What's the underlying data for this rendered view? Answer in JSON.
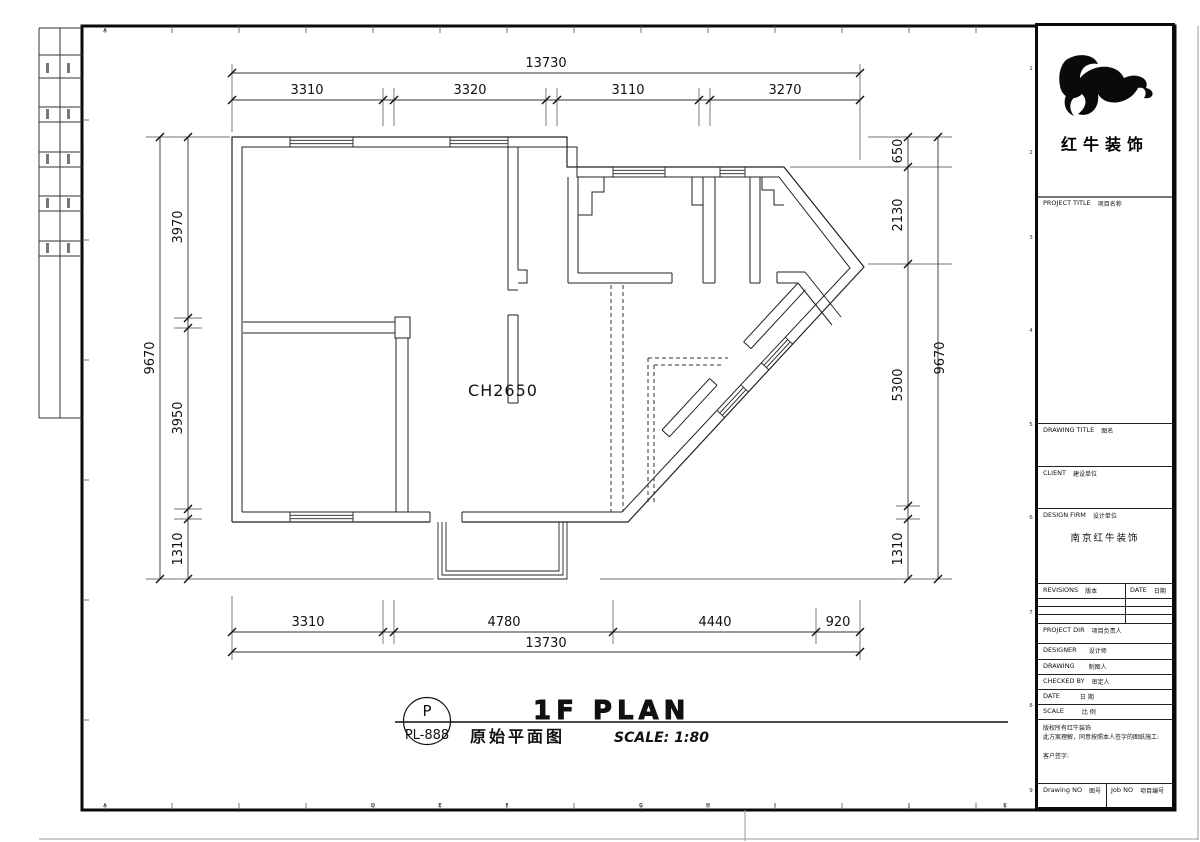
{
  "brand": {
    "name_cn": "红牛装饰",
    "design_firm_value": "南京红牛装饰"
  },
  "title_block": {
    "project_label": "PROJECT TITLE",
    "project_label_cn": "项目名称",
    "drawing_title_label": "DRAWING TITLE",
    "drawing_title_label_cn": "图名",
    "client_label": "CLIENT",
    "client_label_cn": "建设单位",
    "design_firm_label": "DESIGN FIRM",
    "design_firm_label_cn": "设计单位",
    "revisions_label": "REVISIONS",
    "revisions_label_cn": "版本",
    "date_col_label": "DATE",
    "date_col_label_cn": "日期",
    "project_dir_label": "PROJECT DIR",
    "project_dir_label_cn": "项目负责人",
    "designer_label": "DESIGNER",
    "designer_label_cn": "设计师",
    "drawing_by_label": "DRAWING",
    "drawing_by_label_cn": "制图人",
    "checked_by_label": "CHECKED BY",
    "checked_by_label_cn": "审定人",
    "date_label": "DATE",
    "date_label_cn": "日 期",
    "scale_label": "SCALE",
    "scale_label_cn": "比 例",
    "copyright_line1": "版权所有红牛装饰",
    "copyright_line2": "此方案理解，同意按照本人签字的图纸施工:",
    "customer_sign_label": "客户签字:",
    "drawing_no_label": "Drawing NO",
    "drawing_no_label_cn": "图号",
    "job_no_label": "Job NO",
    "job_no_label_cn": "项目编号"
  },
  "plan": {
    "ceiling_label": "CH2650"
  },
  "dims": {
    "top": {
      "overall": "13730",
      "segments": [
        "3310",
        "3320",
        "3110",
        "3270"
      ]
    },
    "bottom": {
      "overall": "13730",
      "segments": [
        "3310",
        "4780",
        "4440",
        "920"
      ]
    },
    "left": {
      "overall": "9670",
      "segments": [
        "3970",
        "3950",
        "1310"
      ]
    },
    "right": {
      "overall": "9670",
      "segments": [
        "650",
        "2130",
        "5300",
        "1310"
      ]
    }
  },
  "sheet_title": {
    "tag_top": "P",
    "tag_bottom": "PL-888",
    "name_en": "1F PLAN",
    "name_cn": "原始平面图",
    "scale_text": "SCALE: 1:80"
  },
  "grid": {
    "top_letter": "A",
    "bottom_letters": [
      "A",
      "D",
      "E",
      "F",
      "G",
      "H",
      "I",
      "J",
      "K"
    ],
    "right_numbers": [
      "1",
      "2",
      "3",
      "4",
      "5",
      "6",
      "7",
      "8",
      "9"
    ]
  }
}
